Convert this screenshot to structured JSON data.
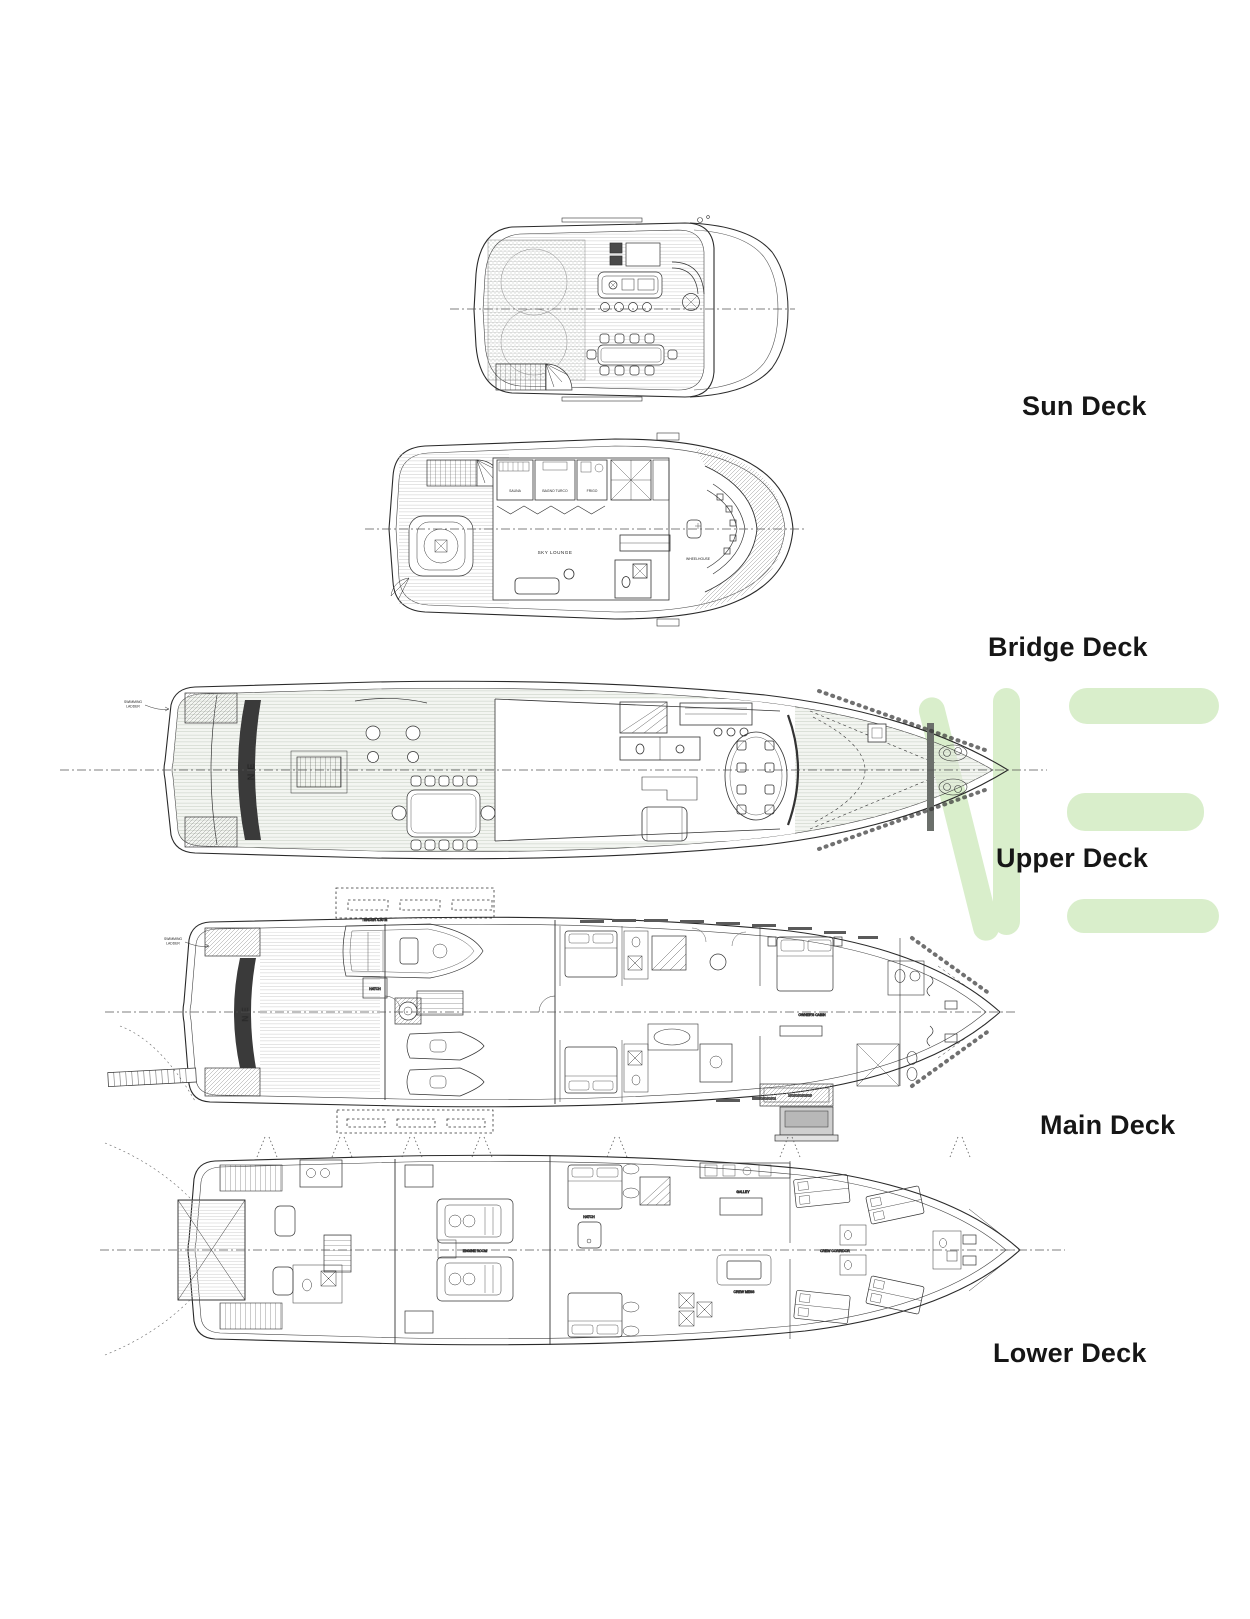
{
  "watermark": {
    "color": "#d9eecb"
  },
  "yacht_name": "NE",
  "decks": [
    {
      "name": "Sun Deck"
    },
    {
      "name": "Bridge Deck",
      "rooms": {
        "sauna": "SAUNA",
        "turkish_bath": "BAGNO TURCO",
        "fridge": "FRIGO",
        "sky_lounge": "SKY LOUNGE",
        "wheelhouse": "WHEELHOUSE"
      }
    },
    {
      "name": "Upper Deck",
      "annotations": {
        "ladder_l1": "SWIMMING",
        "ladder_l2": "LADDER"
      }
    },
    {
      "name": "Main Deck",
      "rooms": {
        "tender": "TENDER 4.50 m",
        "hatch": "HATCH",
        "owners_cabin": "OWNER'S CABIN"
      },
      "annotations": {
        "ladder_l1": "SWIMMING",
        "ladder_l2": "LADDER"
      }
    },
    {
      "name": "Lower Deck",
      "rooms": {
        "engine_room": "ENGINE ROOM",
        "hatch": "HATCH",
        "galley": "GALLEY",
        "crew_mess": "CREW MESS",
        "crew_corridor": "CREW CORRIDOR"
      }
    }
  ]
}
